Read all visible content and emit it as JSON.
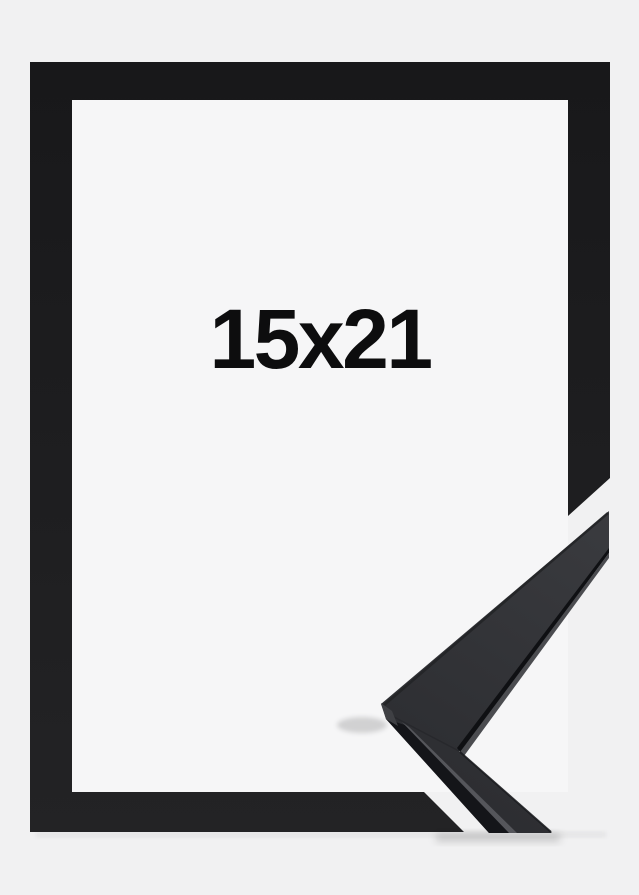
{
  "image": {
    "type": "product-photo",
    "subject": "black picture frame with corner profile sample",
    "size_label": "15x21"
  },
  "colors": {
    "page-bg": "#f1f1f2",
    "frame-interior": "#f6f6f7",
    "frame-black-top": "#18181a",
    "frame-black-bottom": "#232325",
    "molding-top-light": "#3a3b3f",
    "molding-top-dark": "#2c2d31",
    "molding-front": "#141519",
    "molding-highlight": "#55565b",
    "molding-edge-dark": "#0f1013",
    "molding-edge-lip": "#4b4c50",
    "molding-tip-facet": "#3f4044",
    "label-text": "#0d0d0e"
  }
}
